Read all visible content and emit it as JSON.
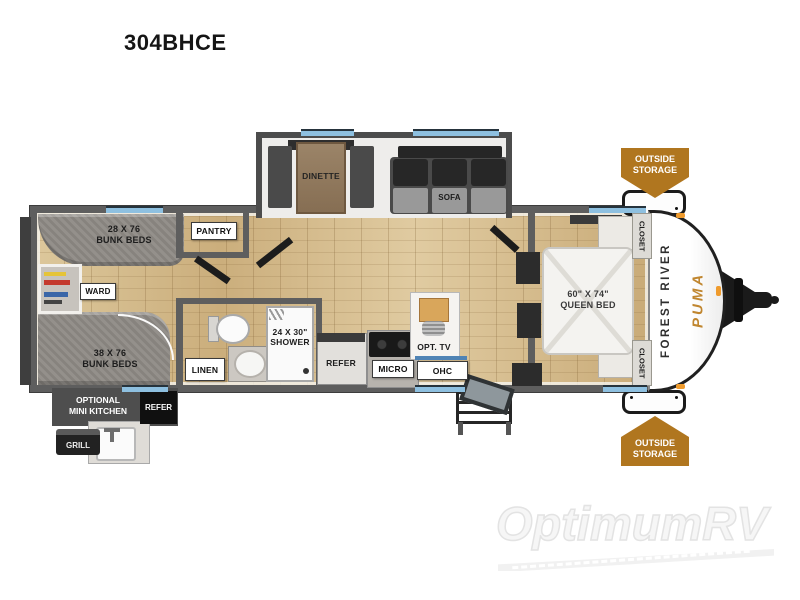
{
  "title": "304BHCE",
  "colors": {
    "accent_orange": "#b0761f",
    "window_blue": "#8ec0e0",
    "wall_gray": "#5e5e5e",
    "floor_tan": "#d5ba8c",
    "brand_orange": "#c0862f"
  },
  "slideout": {
    "dinette_label": "DINETTE",
    "sofa_label": "SOFA"
  },
  "rear_room": {
    "bunk_small_size": "28 X 76",
    "bunk_small_name": "BUNK BEDS",
    "bunk_large_size": "38 X 76",
    "bunk_large_name": "BUNK BEDS",
    "ward_label": "WARD"
  },
  "bath": {
    "pantry_label": "PANTRY",
    "linen_label": "LINEN",
    "shower_size": "24 X 30\"",
    "shower_name": "SHOWER"
  },
  "kitchen": {
    "refer_label": "REFER",
    "micro_label": "MICRO",
    "ohc_label": "OHC",
    "opt_tv_label": "OPT. TV"
  },
  "bedroom": {
    "bed_size": "60\" X 74\"",
    "bed_name": "QUEEN BED",
    "closet_top_label": "CLOSET",
    "closet_bottom_label": "CLOSET"
  },
  "exterior": {
    "outside_storage_top": {
      "line1": "OUTSIDE",
      "line2": "STORAGE"
    },
    "outside_storage_bottom": {
      "line1": "OUTSIDE",
      "line2": "STORAGE"
    },
    "mini_kitchen_line1": "OPTIONAL",
    "mini_kitchen_line2": "MINI KITCHEN",
    "refer_label": "REFER",
    "grill_label": "GRILL"
  },
  "brand": {
    "manufacturer": "FOREST RIVER",
    "model": "PUMA"
  },
  "watermark": "OptimumRV"
}
